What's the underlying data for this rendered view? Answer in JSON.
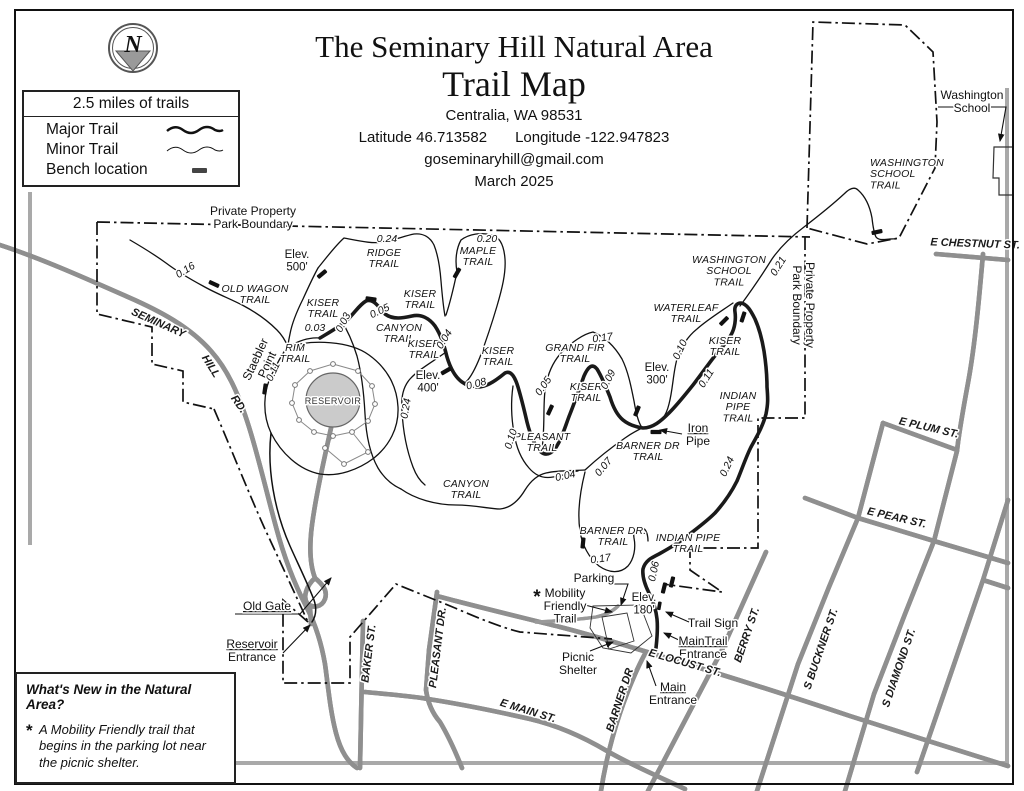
{
  "title_block": {
    "title_line1": "The Seminary Hill Natural Area",
    "title_line2": "Trail Map",
    "city": "Centralia, WA 98531",
    "latitude": "Latitude 46.713582",
    "longitude": "Longitude -122.947823",
    "email": "goseminaryhill@gmail.com",
    "date": "March 2025"
  },
  "north_arrow": {
    "letter": "N"
  },
  "legend": {
    "scale_note": "2.5 miles of trails",
    "items": [
      {
        "label": "Major Trail",
        "symbol": "thick-wavy-line"
      },
      {
        "label": "Minor Trail",
        "symbol": "thin-wavy-line"
      },
      {
        "label": "Bench location",
        "symbol": "filled-rectangle"
      }
    ]
  },
  "whats_new": {
    "heading": "What's New in the Natural Area?",
    "bullet_marker": "*",
    "body": "A Mobility Friendly trail that begins in the parking lot near the picnic shelter."
  },
  "map": {
    "colors": {
      "reservoir_fill": "#cbcbcb",
      "road_casing": "#8f8f8f",
      "trail": "#1a1a1a"
    },
    "labels": [
      {
        "t": [
          "Private Property",
          "Park Boundary"
        ],
        "x": 253,
        "y": 215,
        "c": "ann"
      },
      {
        "t": [
          "Private Property",
          "Park Boundary"
        ],
        "x": 806,
        "y": 305,
        "r": 90,
        "c": "ann"
      },
      {
        "t": [
          "OLD WAGON",
          "TRAIL"
        ],
        "x": 255,
        "y": 292,
        "c": "trail"
      },
      {
        "t": [
          "Elev.",
          "500'"
        ],
        "x": 297,
        "y": 258,
        "c": "elev"
      },
      {
        "t": [
          "RIDGE",
          "TRAIL"
        ],
        "x": 384,
        "y": 256,
        "c": "trail"
      },
      {
        "t": [
          "MAPLE",
          "TRAIL"
        ],
        "x": 478,
        "y": 254,
        "c": "trail"
      },
      {
        "t": [
          "KISER",
          "TRAIL"
        ],
        "x": 323,
        "y": 306,
        "c": "trail"
      },
      {
        "t": [
          "KISER",
          "TRAIL"
        ],
        "x": 420,
        "y": 297,
        "c": "trail"
      },
      {
        "t": [
          "CANYON",
          "TRAIL"
        ],
        "x": 399,
        "y": 331,
        "c": "trail"
      },
      {
        "t": [
          "KISER",
          "TRAIL"
        ],
        "x": 424,
        "y": 347,
        "c": "trail"
      },
      {
        "t": [
          "RIM",
          "TRAIL"
        ],
        "x": 295,
        "y": 351,
        "c": "trail"
      },
      {
        "t": [
          "KISER",
          "TRAIL"
        ],
        "x": 498,
        "y": 354,
        "c": "trail"
      },
      {
        "t": [
          "GRAND FIR",
          "TRAIL"
        ],
        "x": 575,
        "y": 351,
        "c": "trail"
      },
      {
        "t": [
          "KISER",
          "TRAIL"
        ],
        "x": 586,
        "y": 390,
        "c": "trail"
      },
      {
        "t": [
          "KISER",
          "TRAIL"
        ],
        "x": 725,
        "y": 344,
        "c": "trail"
      },
      {
        "t": [
          "WATERLEAF",
          "TRAIL"
        ],
        "x": 686,
        "y": 311,
        "c": "trail"
      },
      {
        "t": [
          "WASHINGTON",
          "SCHOOL",
          "TRAIL"
        ],
        "x": 729,
        "y": 263,
        "c": "trail"
      },
      {
        "t": [
          "WASHINGTON",
          "SCHOOL",
          "TRAIL"
        ],
        "x": 870,
        "y": 166,
        "c": "trail",
        "a": "start"
      },
      {
        "t": [
          "INDIAN",
          "PIPE",
          "TRAIL"
        ],
        "x": 738,
        "y": 399,
        "c": "trail"
      },
      {
        "t": [
          "PLEASANT",
          "TRAIL"
        ],
        "x": 542,
        "y": 440,
        "c": "trail"
      },
      {
        "t": [
          "CANYON",
          "TRAIL"
        ],
        "x": 466,
        "y": 487,
        "c": "trail"
      },
      {
        "t": [
          "BARNER DR",
          "TRAIL"
        ],
        "x": 648,
        "y": 449,
        "c": "trail"
      },
      {
        "t": [
          "BARNER DR.",
          "TRAIL"
        ],
        "x": 613,
        "y": 534,
        "c": "trail"
      },
      {
        "t": [
          "INDIAN PIPE",
          "TRAIL"
        ],
        "x": 688,
        "y": 541,
        "c": "trail"
      },
      {
        "t": [
          "Elev.",
          "400'"
        ],
        "x": 428,
        "y": 379,
        "c": "elev"
      },
      {
        "t": [
          "Elev.",
          "300'"
        ],
        "x": 657,
        "y": 371,
        "c": "elev"
      },
      {
        "t": [
          "Elev.",
          "180'"
        ],
        "x": 644,
        "y": 601,
        "c": "elev"
      },
      {
        "t": "RESERVOIR",
        "x": 333,
        "y": 404,
        "c": "place"
      },
      {
        "t": [
          "Staebler",
          "Point"
        ],
        "x": 259,
        "y": 361,
        "r": -65,
        "c": "ann"
      },
      {
        "t": "0.16",
        "x": 187,
        "y": 273,
        "r": -32,
        "c": "dist"
      },
      {
        "t": "0.24",
        "x": 387,
        "y": 242,
        "c": "dist"
      },
      {
        "t": "0.20",
        "x": 487,
        "y": 242,
        "c": "dist"
      },
      {
        "t": "0.05",
        "x": 381,
        "y": 314,
        "r": -25,
        "c": "dist"
      },
      {
        "t": "0.03",
        "x": 315,
        "y": 331,
        "c": "dist"
      },
      {
        "t": "0.03",
        "x": 346,
        "y": 324,
        "r": -62,
        "c": "dist"
      },
      {
        "t": "0.04",
        "x": 447,
        "y": 341,
        "r": -58,
        "c": "dist"
      },
      {
        "t": "0.11",
        "x": 276,
        "y": 373,
        "r": -65,
        "c": "dist"
      },
      {
        "t": "0.24",
        "x": 409,
        "y": 409,
        "r": -80,
        "c": "dist"
      },
      {
        "t": "0.08",
        "x": 477,
        "y": 387,
        "r": -15,
        "c": "dist"
      },
      {
        "t": "0.05",
        "x": 546,
        "y": 388,
        "r": -55,
        "c": "dist"
      },
      {
        "t": "0.17",
        "x": 603,
        "y": 341,
        "r": -8,
        "c": "dist"
      },
      {
        "t": "0.09",
        "x": 611,
        "y": 381,
        "r": -62,
        "c": "dist"
      },
      {
        "t": "0.10",
        "x": 514,
        "y": 440,
        "r": -72,
        "c": "dist"
      },
      {
        "t": "0.04",
        "x": 566,
        "y": 479,
        "r": -12,
        "c": "dist"
      },
      {
        "t": "0.07",
        "x": 606,
        "y": 469,
        "r": -50,
        "c": "dist"
      },
      {
        "t": "0.10",
        "x": 683,
        "y": 351,
        "r": -65,
        "c": "dist"
      },
      {
        "t": "0.11",
        "x": 709,
        "y": 380,
        "r": -58,
        "c": "dist"
      },
      {
        "t": "0.21",
        "x": 781,
        "y": 268,
        "r": -58,
        "c": "dist"
      },
      {
        "t": "0.24",
        "x": 730,
        "y": 468,
        "r": -65,
        "c": "dist"
      },
      {
        "t": "0.17",
        "x": 601,
        "y": 562,
        "r": -8,
        "c": "dist"
      },
      {
        "t": "0.06",
        "x": 657,
        "y": 572,
        "r": -78,
        "c": "dist"
      },
      {
        "t": [
          "Washington",
          "School"
        ],
        "x": 972,
        "y": 99,
        "c": "ann"
      },
      {
        "t": "Old Gate",
        "x": 267,
        "y": 610,
        "c": "ann",
        "u": 1
      },
      {
        "t": [
          "Reservoir",
          "Entrance"
        ],
        "x": 252,
        "y": 648,
        "c": "ann",
        "u": 1
      },
      {
        "t": [
          "Iron",
          "Pipe"
        ],
        "x": 698,
        "y": 432,
        "c": "ann",
        "u": 1
      },
      {
        "t": "Parking",
        "x": 594,
        "y": 582,
        "c": "ann"
      },
      {
        "t": [
          "Mobility",
          "Friendly",
          "Trail"
        ],
        "x": 565,
        "y": 597,
        "c": "ann"
      },
      {
        "t": "*",
        "x": 537,
        "y": 603,
        "c": "ast"
      },
      {
        "t": "Trail Sign",
        "x": 713,
        "y": 627,
        "c": "ann"
      },
      {
        "t": [
          "MainTrail",
          "Entrance"
        ],
        "x": 703,
        "y": 645,
        "c": "ann",
        "u": 1
      },
      {
        "t": [
          "Picnic",
          "Shelter"
        ],
        "x": 578,
        "y": 661,
        "c": "ann"
      },
      {
        "t": [
          "Main",
          "Entrance"
        ],
        "x": 673,
        "y": 691,
        "c": "ann",
        "u": 1
      },
      {
        "t": "SEMINARY",
        "x": 157,
        "y": 326,
        "r": 24,
        "c": "street"
      },
      {
        "t": "HILL",
        "x": 208,
        "y": 368,
        "r": 58,
        "c": "street"
      },
      {
        "t": "RD.",
        "x": 236,
        "y": 406,
        "r": 55,
        "c": "street"
      },
      {
        "t": "BAKER ST.",
        "x": 372,
        "y": 654,
        "r": -83,
        "c": "street"
      },
      {
        "t": "PLEASANT DR.",
        "x": 441,
        "y": 648,
        "r": -83,
        "c": "street"
      },
      {
        "t": "BARNER DR",
        "x": 623,
        "y": 701,
        "r": -72,
        "c": "street"
      },
      {
        "t": "E LOCUST ST.",
        "x": 684,
        "y": 666,
        "r": 16,
        "c": "street"
      },
      {
        "t": "E MAIN ST.",
        "x": 527,
        "y": 714,
        "r": 17,
        "c": "street"
      },
      {
        "t": "BERRY ST.",
        "x": 750,
        "y": 636,
        "r": -71,
        "c": "street"
      },
      {
        "t": "S BUCKNER ST.",
        "x": 824,
        "y": 650,
        "r": -71,
        "c": "street"
      },
      {
        "t": "S DIAMOND ST.",
        "x": 902,
        "y": 669,
        "r": -71,
        "c": "street"
      },
      {
        "t": "E PLUM ST.",
        "x": 928,
        "y": 431,
        "r": 13,
        "c": "street"
      },
      {
        "t": "E PEAR ST.",
        "x": 896,
        "y": 521,
        "r": 13,
        "c": "street"
      },
      {
        "t": "E CHESTNUT ST.",
        "x": 975,
        "y": 247,
        "r": 2,
        "c": "street"
      }
    ],
    "benches": [
      {
        "x": 214,
        "y": 284,
        "r": 25
      },
      {
        "x": 322,
        "y": 274,
        "r": -40
      },
      {
        "x": 371,
        "y": 299,
        "r": 8
      },
      {
        "x": 457,
        "y": 273,
        "r": -60
      },
      {
        "x": 265,
        "y": 389,
        "r": -82
      },
      {
        "x": 446,
        "y": 371,
        "r": -30
      },
      {
        "x": 550,
        "y": 410,
        "r": -65
      },
      {
        "x": 583,
        "y": 543,
        "r": -84
      },
      {
        "x": 637,
        "y": 411,
        "r": -68
      },
      {
        "x": 656,
        "y": 432,
        "r": 0
      },
      {
        "x": 724,
        "y": 321,
        "r": -45
      },
      {
        "x": 743,
        "y": 317,
        "r": -72
      },
      {
        "x": 877,
        "y": 232,
        "r": -12
      },
      {
        "x": 664,
        "y": 588,
        "r": -76
      },
      {
        "x": 672,
        "y": 582,
        "r": -76
      }
    ]
  }
}
